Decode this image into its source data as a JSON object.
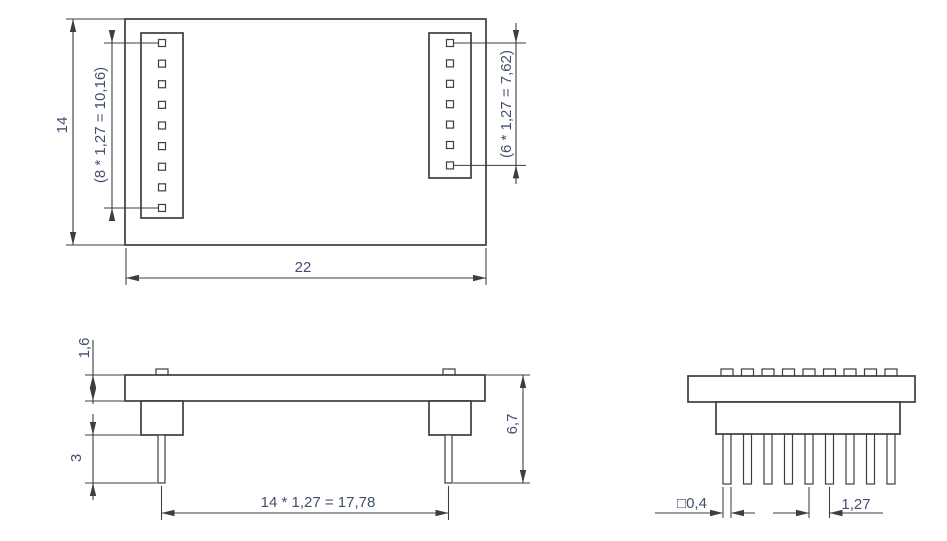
{
  "drawing": {
    "colors": {
      "background": "#ffffff",
      "line": "#3e3e3e",
      "dim_text": "#434f6f"
    },
    "views": {
      "top_view": {
        "left_pin_count": 9,
        "right_pin_count": 7,
        "dims": {
          "board_height": "14",
          "board_width": "22",
          "left_pin_row_span": "(8 * 1,27 = 10,16)",
          "right_pin_row_span": "(6 * 1,27 = 7,62)"
        }
      },
      "front_view": {
        "dims": {
          "board_thickness": "1,6",
          "pin_protrusion": "3",
          "overall_height": "6,7",
          "pin_column_span": "14 * 1,27 = 17,78"
        }
      },
      "end_view": {
        "pin_count": 9,
        "dims": {
          "pin_cross_section": "□0,4",
          "pin_pitch": "1,27"
        }
      }
    }
  }
}
